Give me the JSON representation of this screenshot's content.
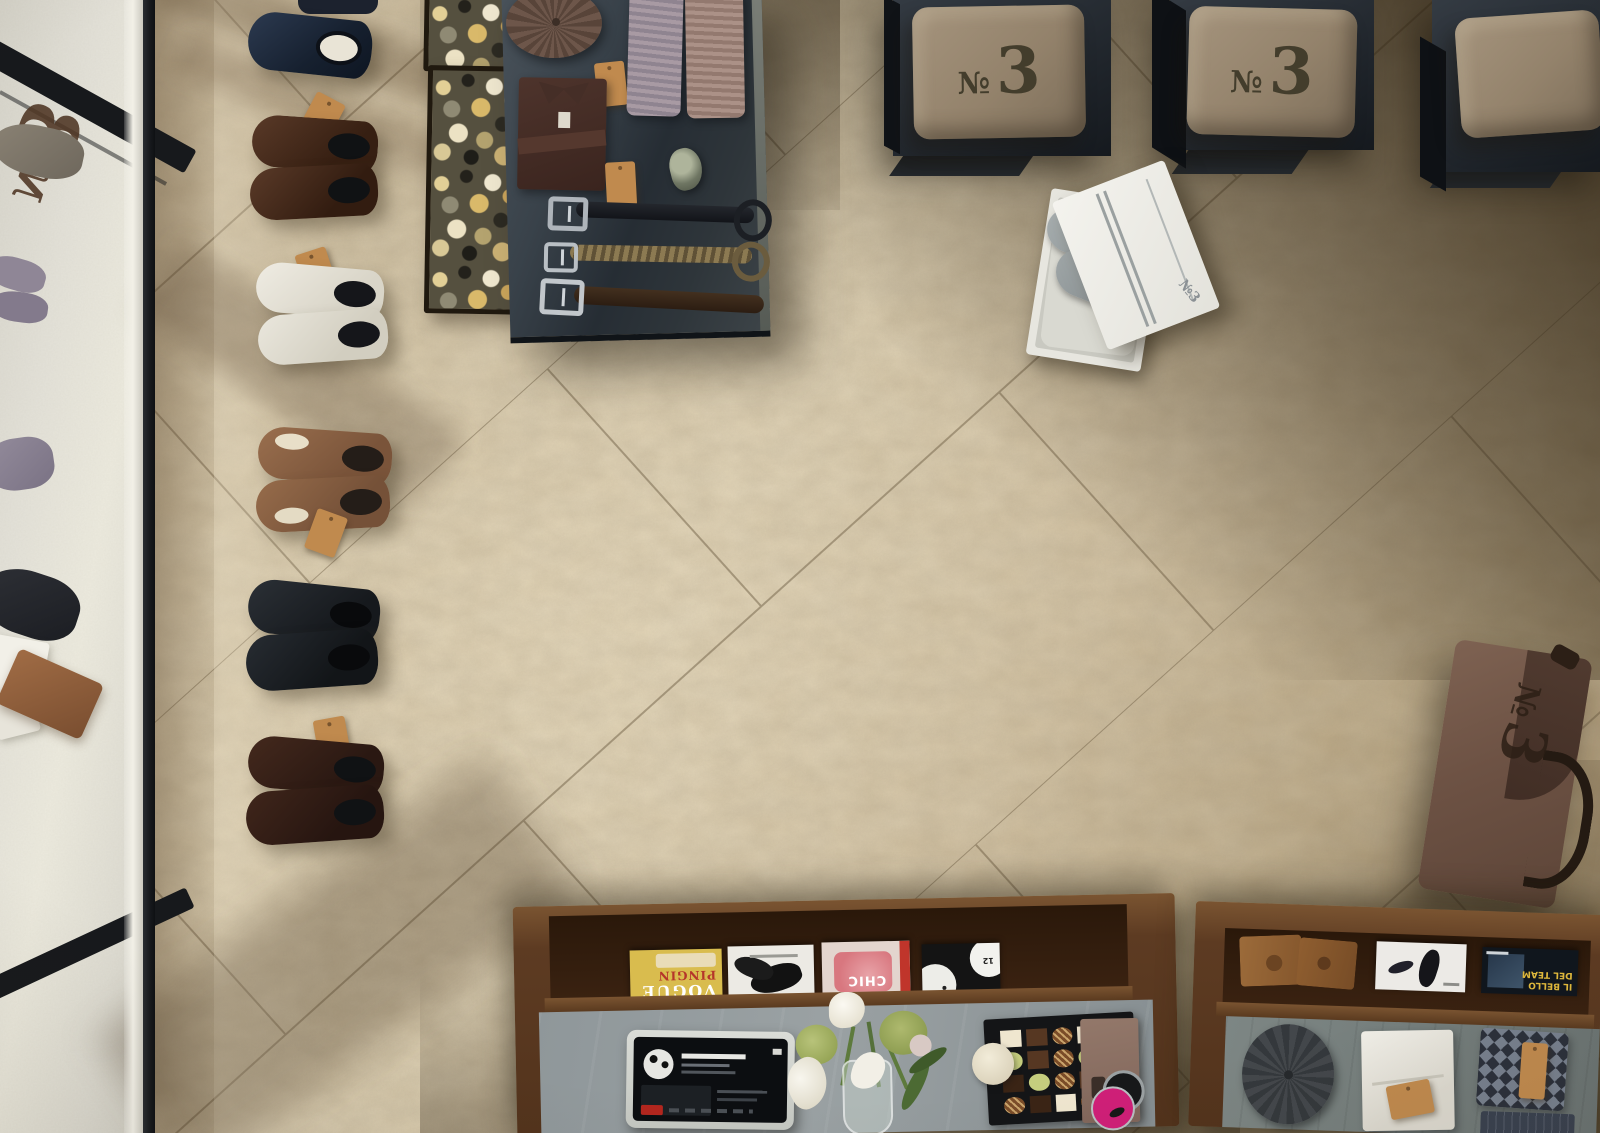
{
  "scene": {
    "title": "Menswear boutique floor, overhead view"
  },
  "glass_decal": {
    "no": "№",
    "three": "3"
  },
  "benches": {
    "cushion_no": "№",
    "cushion_three": "3"
  },
  "shoebox": {
    "lid_text": "№3"
  },
  "tote": {
    "no": "№",
    "three": "3"
  },
  "magazines_left": {
    "vogue": {
      "overline": "PINGIN",
      "title": "VOGUE"
    },
    "chic": {
      "title": "CHIC"
    },
    "clocks": {
      "numeral": "12"
    }
  },
  "magazines_right": {
    "ilbello": {
      "line1": "IL BELLO",
      "line2": "DEL TEAM"
    }
  },
  "colors": {
    "floor_beige": "#cdbc9c",
    "floor_dark": "#3f3019",
    "outside_floor": "#e0ded5",
    "frame_black": "#17191c",
    "steel_table": "#2e363d",
    "bench_metal": "#23282e",
    "cushion_tan": "#93826b",
    "stencil": "#433d2c",
    "kraft": "#c08a4e",
    "wood": "#5d3b22",
    "concrete": "#8f979a",
    "slate": "#79827f",
    "vogue_yellow": "#d9bc4e",
    "magenta": "#cf1f78",
    "red_accent": "#b3261e",
    "tote_brown": "#75594a",
    "grout": "#6f5f45"
  }
}
